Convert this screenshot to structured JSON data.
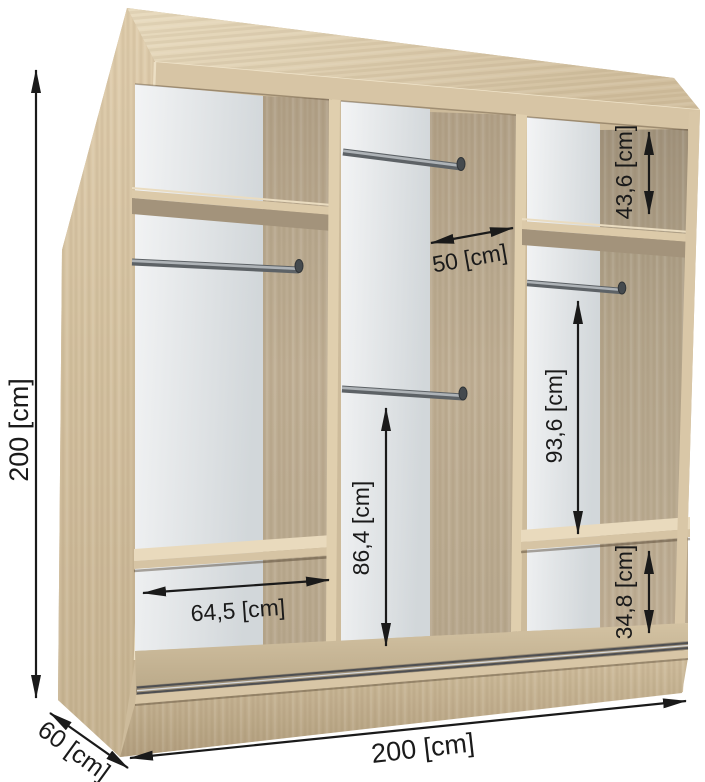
{
  "figure": {
    "type": "wardrobe-interior-dimension-diagram",
    "subject": "three-section sliding-door wardrobe shown in cutaway perspective",
    "sections": [
      "left",
      "middle",
      "right"
    ]
  },
  "dimensions": {
    "overall_height": "200 [cm]",
    "overall_width": "200 [cm]",
    "overall_depth": "60 [cm]",
    "right_top_compartment_height": "43,6 [cm]",
    "middle_compartment_width": "50 [cm]",
    "right_hanging_space_height": "93,6 [cm]",
    "middle_hanging_space_height": "86,4 [cm]",
    "left_compartment_width": "64,5 [cm]",
    "right_bottom_compartment_height": "34,8 [cm]"
  },
  "colors": {
    "wood_light": "#e9dcc0",
    "wood_mid": "#d2c0a0",
    "wood_face_shadow": "#b2a289",
    "back_panel_light": "#f3f4f5",
    "back_panel_dark": "#d2d7da",
    "metal_rod": "#5d6266",
    "dimension_ink": "#1a1a1a",
    "background": "#ffffff"
  }
}
